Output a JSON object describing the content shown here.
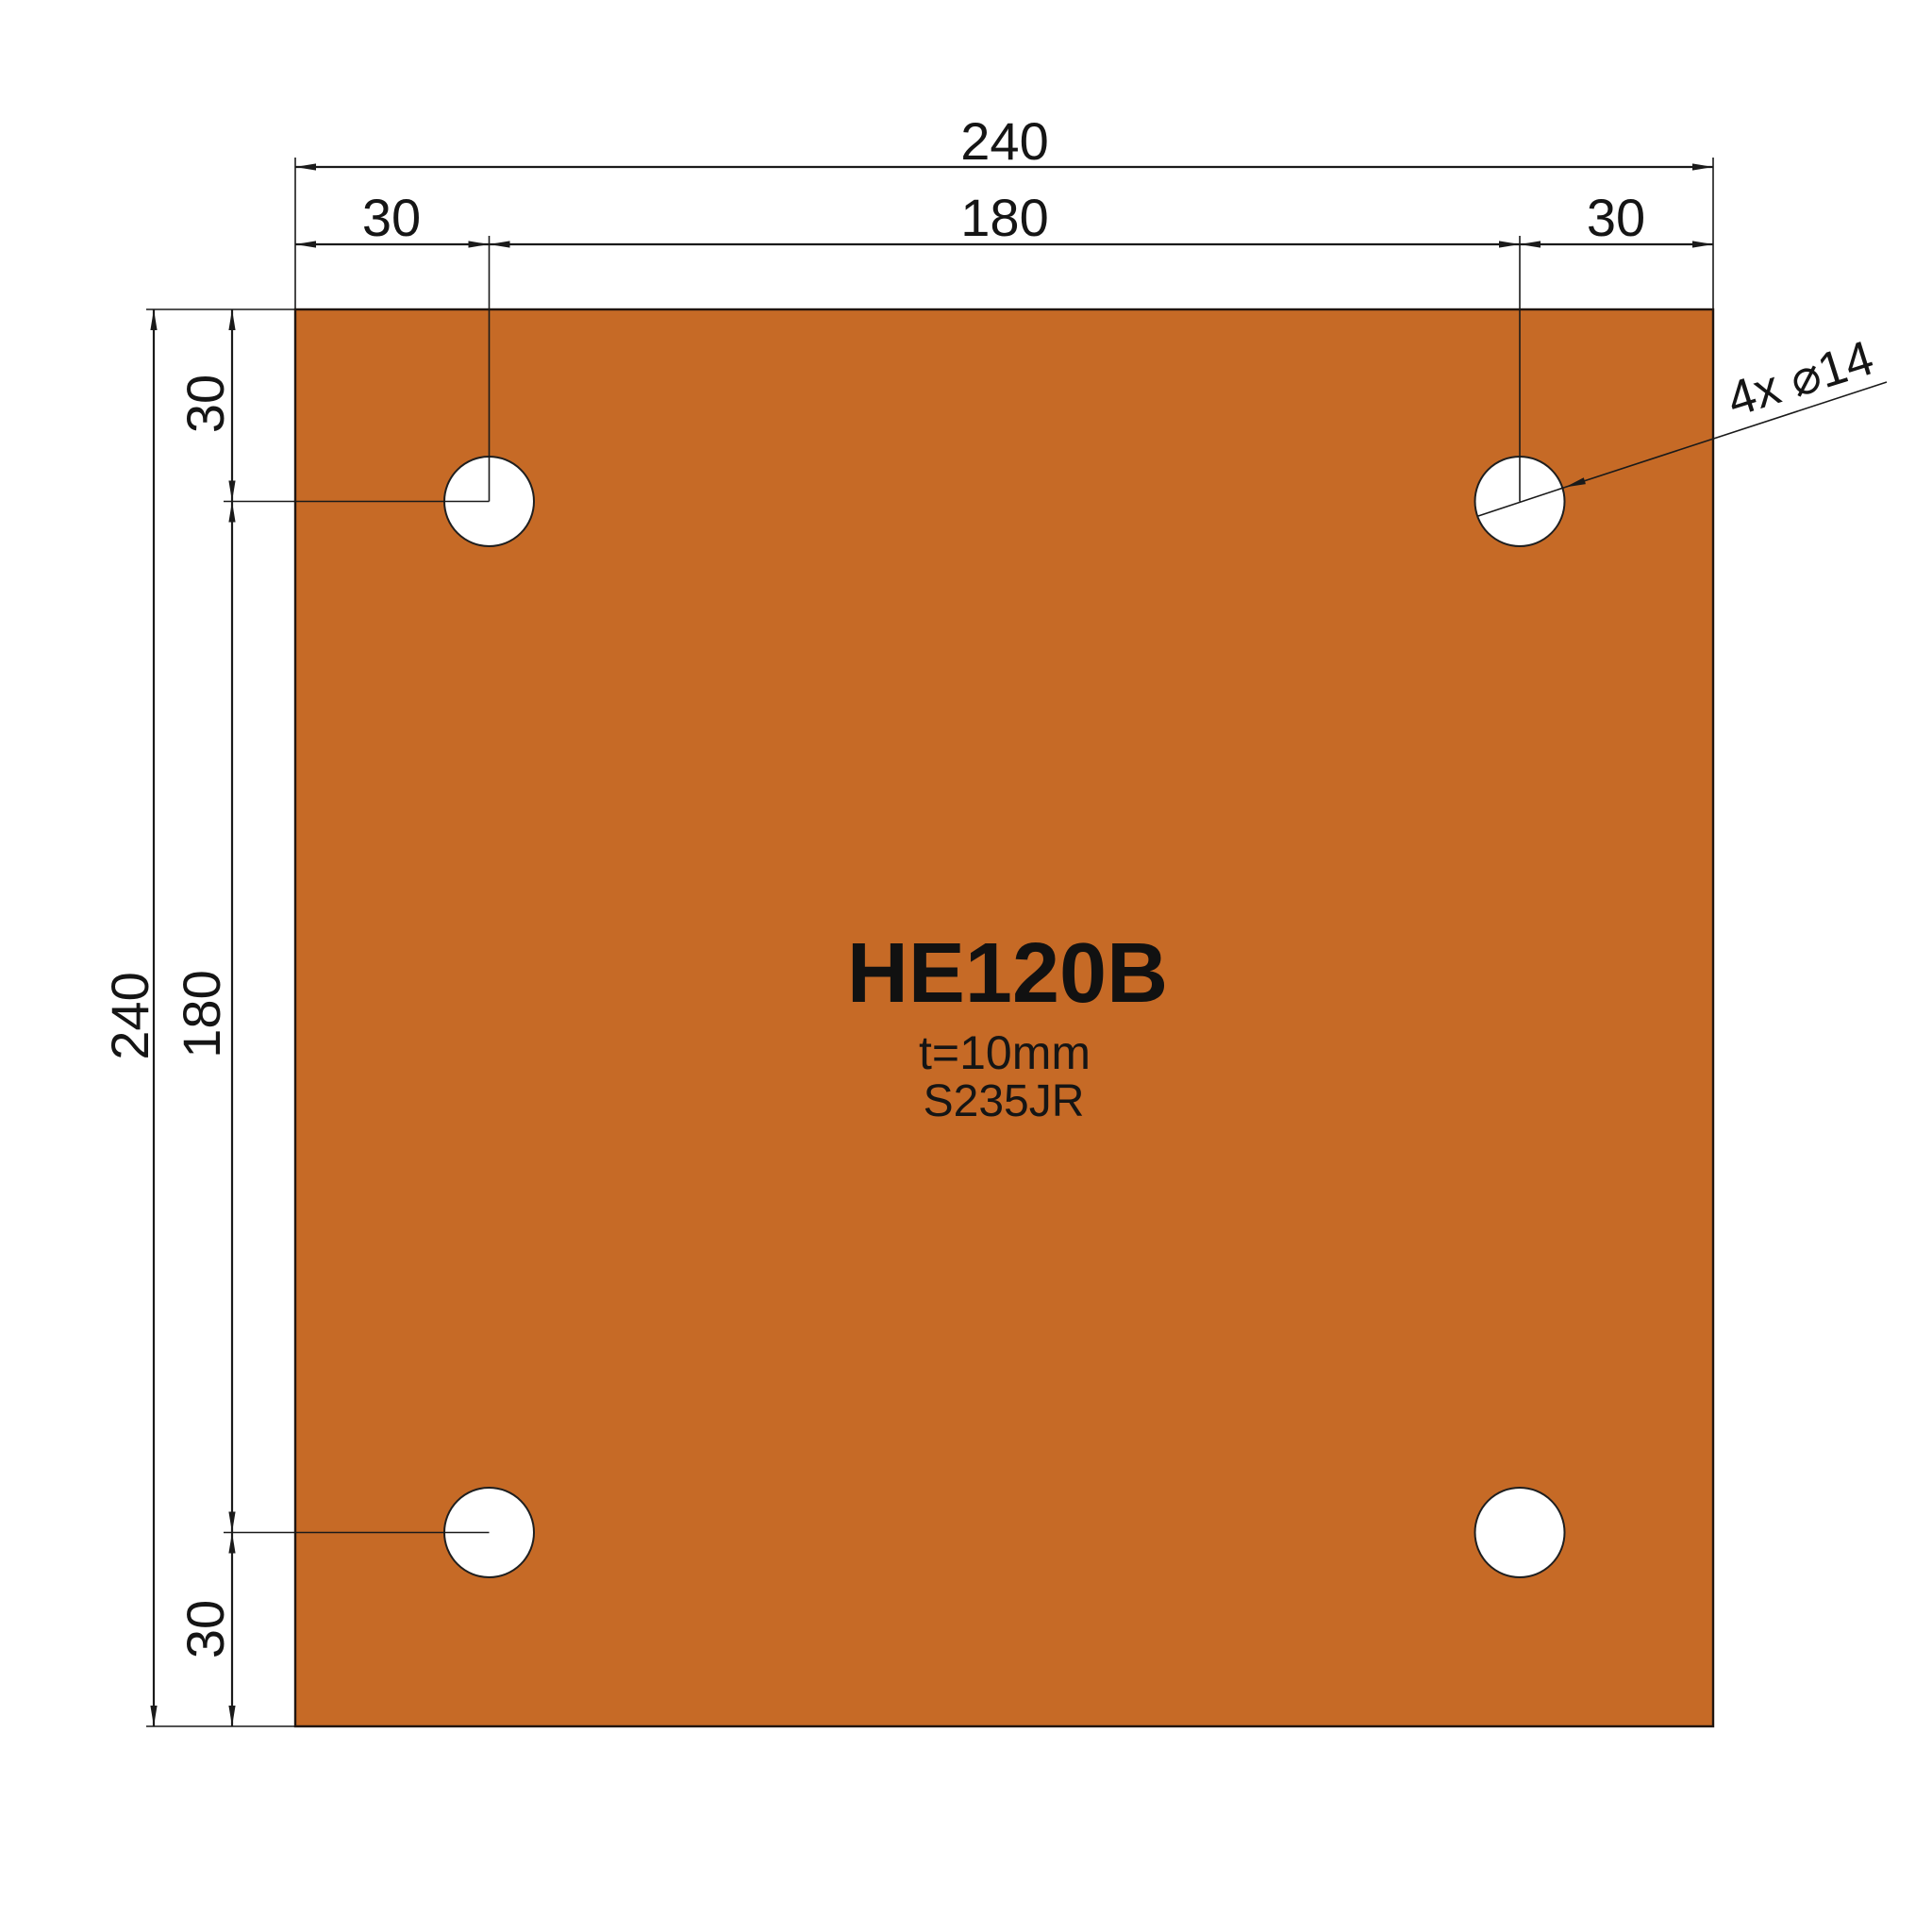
{
  "title_block": {
    "part": "HE120B",
    "thickness": "t=10mm",
    "material": "S235JR"
  },
  "annotations": {
    "holes_note": "4x ⌀14"
  },
  "dimensions": {
    "top": {
      "overall": "240",
      "left_edge": "30",
      "center_spacing": "180",
      "right_edge": "30"
    },
    "left": {
      "overall": "240",
      "top_edge": "30",
      "center_spacing": "180",
      "bottom_edge": "30"
    }
  },
  "colors": {
    "plate_fill": "#C66A26",
    "line": "#1A1A1A",
    "background": "#FFFFFF"
  }
}
